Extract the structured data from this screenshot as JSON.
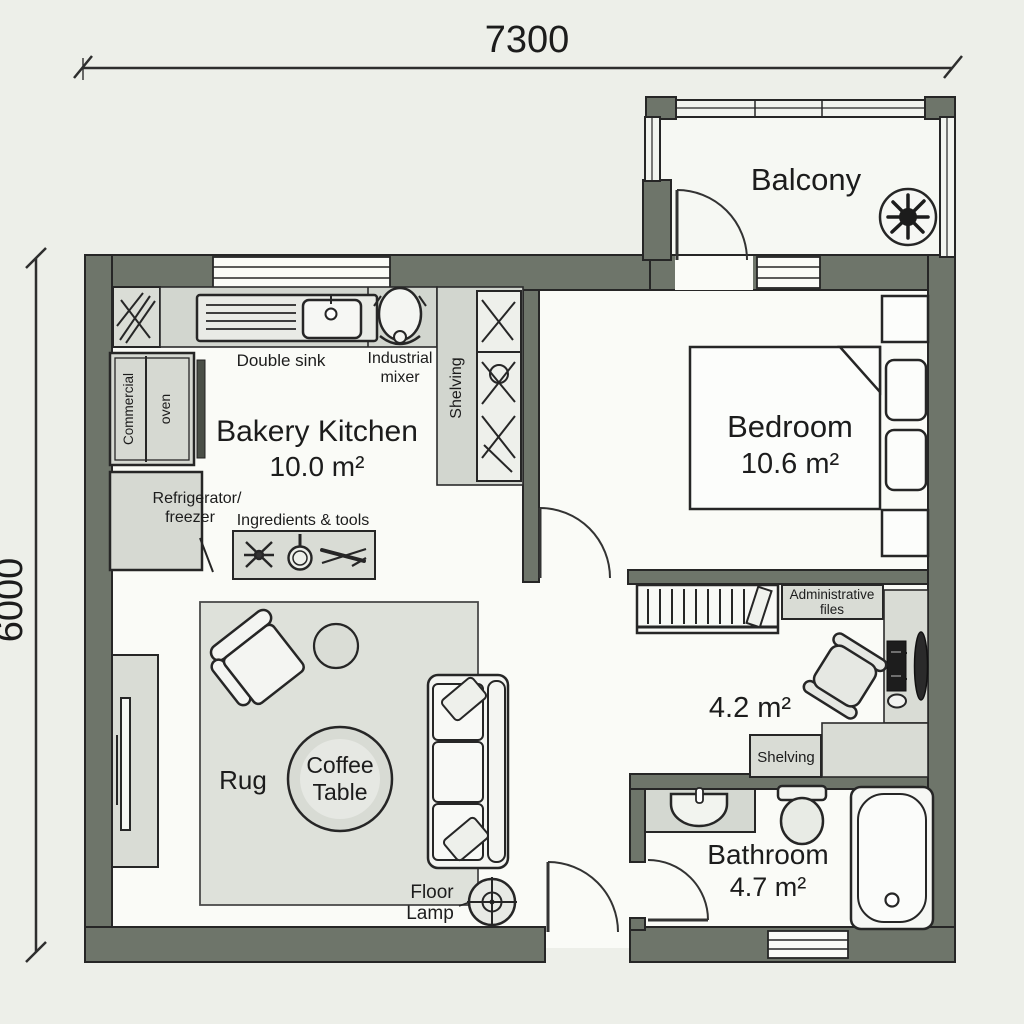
{
  "dimension": {
    "top": "7300",
    "left": "6000"
  },
  "rooms": {
    "kitchen": {
      "name": "Bakery Kitchen",
      "area": "10.0 m²"
    },
    "bedroom": {
      "name": "Bedroom",
      "area": "10.6 m²"
    },
    "balcony": {
      "name": "Balcony"
    },
    "office": {
      "area": "4.2 m²"
    },
    "bathroom": {
      "name": "Bathroom",
      "area": "4.7 m²"
    }
  },
  "labels": {
    "double_sink": "Double sink",
    "mixer_line1": "Industrial",
    "mixer_line2": "mixer",
    "oven_line1": "Commercial",
    "oven_line2": "oven",
    "kitchen_shelving": "Shelving",
    "fridge_line1": "Refrigerator/",
    "fridge_line2": "freezer",
    "ingredients": "Ingredients & tools",
    "rug": "Rug",
    "coffee_line1": "Coffee",
    "coffee_line2": "Table",
    "lamp_line1": "Floor",
    "lamp_line2": "Lamp",
    "admin_line1": "Administrative",
    "admin_line2": "files",
    "office_shelving": "Shelving"
  },
  "colors": {
    "wall": "#6e756a",
    "floor": "#fafbf7",
    "furniture_light": "#d9dcd5",
    "background": "#edefe9",
    "ink": "#1c1c1c"
  }
}
